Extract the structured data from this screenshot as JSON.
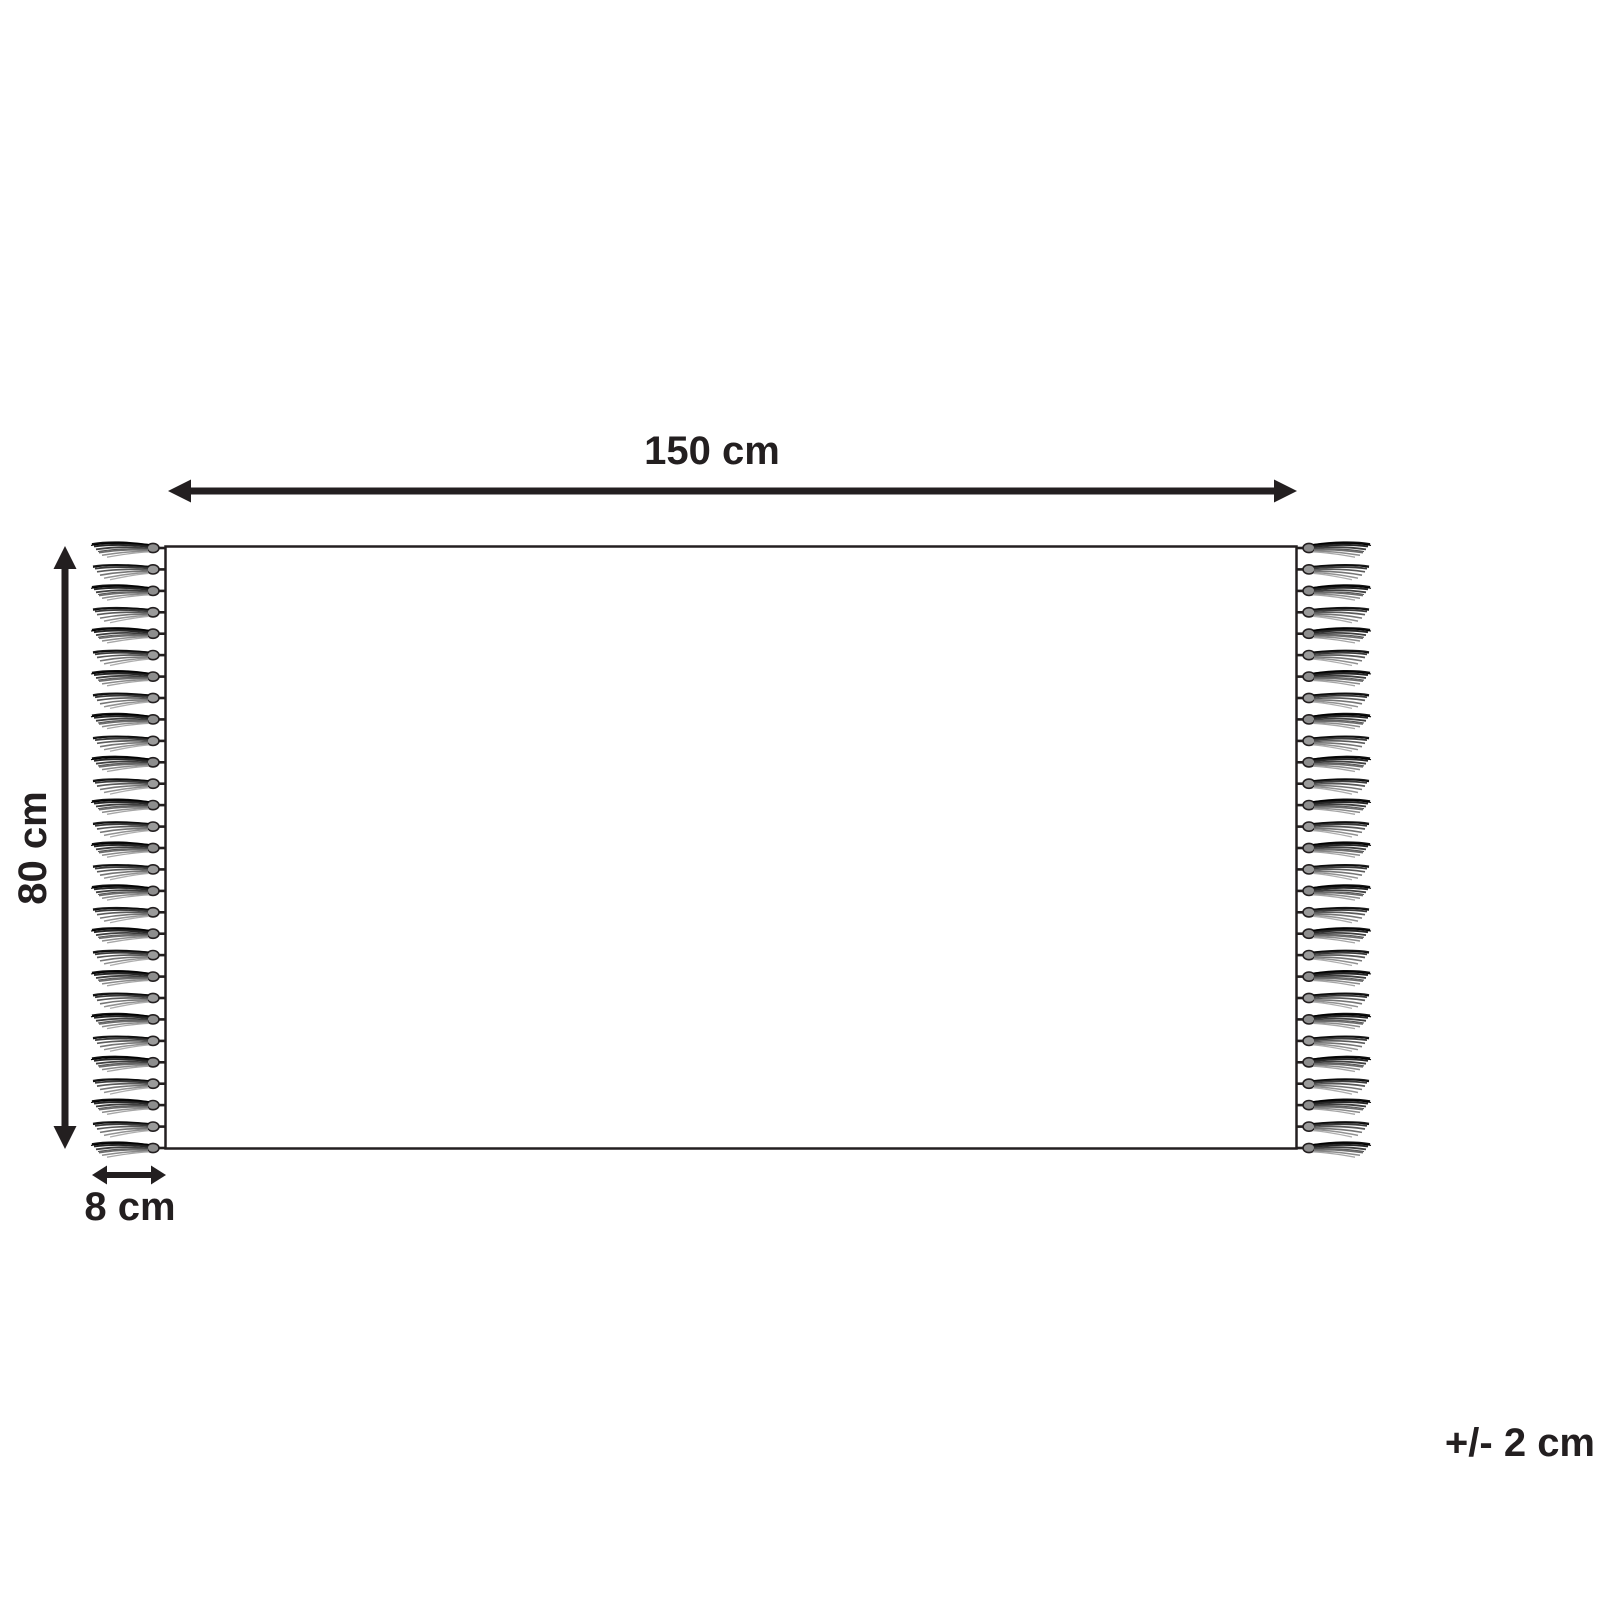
{
  "diagram": {
    "type": "product-dimension-diagram",
    "subject": "rug-with-fringe-top-view",
    "labels": {
      "width": "150 cm",
      "height": "80 cm",
      "fringe": "8 cm",
      "tolerance": "+/- 2 cm"
    },
    "dimensions_cm": {
      "width": 150,
      "height": 80,
      "fringe_length": 8,
      "tolerance": 2
    },
    "colors": {
      "line": "#231f20",
      "background": "#ffffff"
    },
    "fringe": {
      "tassels_per_side": 29,
      "sides": [
        "left",
        "right"
      ]
    }
  }
}
